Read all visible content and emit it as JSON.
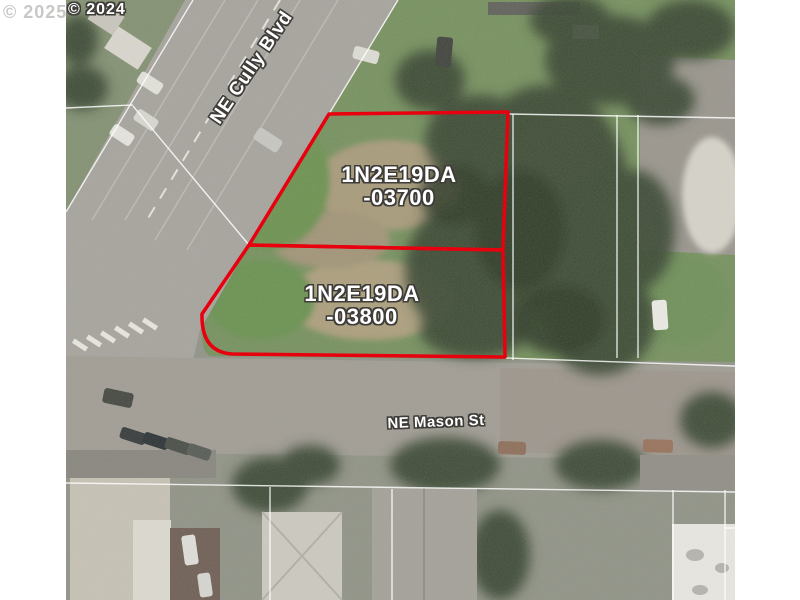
{
  "watermarks": {
    "left": "© 2025",
    "right": "© 2024"
  },
  "streets": {
    "cully": "NE Cully Blvd",
    "mason": "NE Mason St"
  },
  "parcels": [
    {
      "id": "1N2E19DA",
      "lot": "-03700"
    },
    {
      "id": "1N2E19DA",
      "lot": "-03800"
    }
  ],
  "colors": {
    "parcel_outline": "#e8000e",
    "label_text": "#ffffff",
    "label_halo": "#3e3c38",
    "watermark_gray": "#c9c8c6",
    "canvas_background": "#ffffff"
  }
}
